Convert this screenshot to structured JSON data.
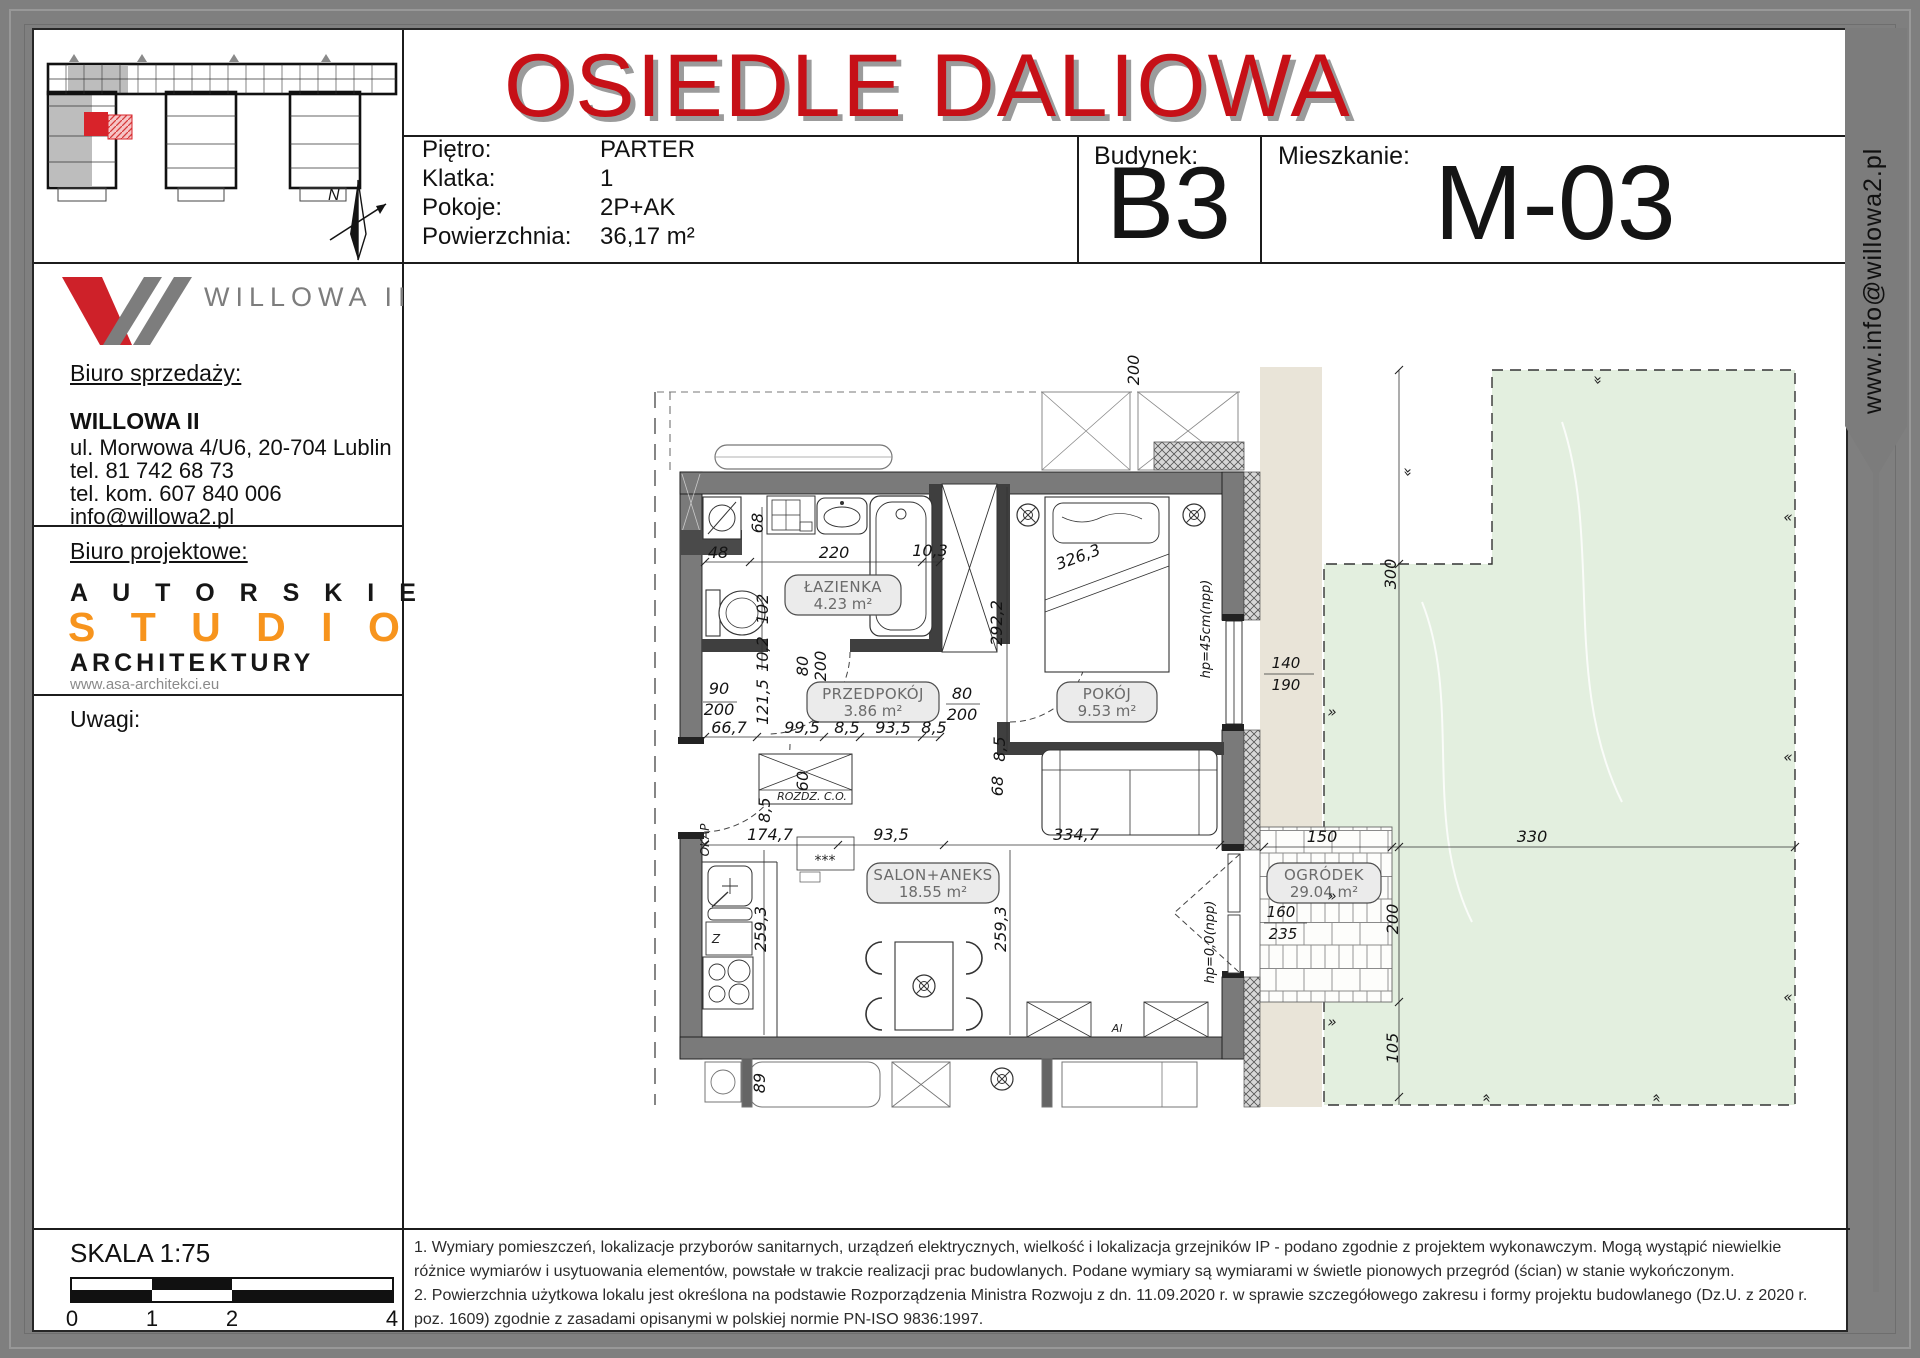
{
  "header": {
    "title": "OSIEDLE DALIOWA",
    "rows": [
      {
        "label": "Piętro:",
        "value": "PARTER"
      },
      {
        "label": "Klatka:",
        "value": "1"
      },
      {
        "label": "Pokoje:",
        "value": "2P+AK"
      },
      {
        "label": "Powierzchnia:",
        "value": "36,17 m²"
      }
    ],
    "budynek_label": "Budynek:",
    "budynek_value": "B3",
    "mieszkanie_label": "Mieszkanie:",
    "mieszkanie_value": "M-03"
  },
  "ribbon": {
    "text": "www.info@willowa2.pl"
  },
  "sidebar": {
    "logo_text": "WILLOWA II",
    "sales_heading": "Biuro sprzedaży:",
    "company": "WILLOWA II",
    "address": "ul. Morwowa 4/U6, 20-704 Lublin",
    "tel1": "tel. 81 742 68 73",
    "tel2": "tel. kom. 607 840 006",
    "email": "info@willowa2.pl",
    "design_heading": "Biuro projektowe:",
    "studio_line1": "A U T O R S K I E",
    "studio_line2": "S T U D I O",
    "studio_line3": "ARCHITEKTURY",
    "studio_site": "www.asa-architekci.eu",
    "uwagi_label": "Uwagi:"
  },
  "footer": {
    "skala_label": "SKALA 1:75",
    "scale_ticks": [
      "0",
      "1",
      "2",
      "4"
    ],
    "note1": "1. Wymiary pomieszczeń, lokalizacje przyborów sanitarnych, urządzeń elektrycznych, wielkość i lokalizacja grzejników IP - podano zgodnie z projektem wykonawczym. Mogą wystąpić niewielkie różnice wymiarów i usytuowania elementów, powstałe w trakcie realizacji prac budowlanych. Podane wymiary są wymiarami w świetle pionowych przegród (ścian) w stanie wykończonym.",
    "note2": "2. Powierzchnia użytkowa lokalu jest określona na podstawie Rozporządzenia Ministra Rozwoju z dn. 11.09.2020 r. w sprawie szczegółowego zakresu i formy projektu budowlanego (Dz.U. z 2020 r. poz. 1609) zgodnie z zasadami opisanymi w polskiej normie PN-ISO 9836:1997."
  },
  "plan": {
    "rooms": [
      {
        "name": "ŁAZIENKA",
        "area": "4.23 m²",
        "x": 841,
        "y": 573,
        "w": 116
      },
      {
        "name": "PRZEDPOKÓJ",
        "area": "3.86 m²",
        "x": 871,
        "y": 680,
        "w": 132
      },
      {
        "name": "POKÓJ",
        "area": "9.53 m²",
        "x": 1105,
        "y": 680,
        "w": 100
      },
      {
        "name": "SALON+ANEKS",
        "area": "18.55 m²",
        "x": 931,
        "y": 861,
        "w": 132
      },
      {
        "name": "OGRÓDEK",
        "area": "29.04 m²",
        "x": 1322,
        "y": 861,
        "w": 114
      }
    ],
    "dims": [
      {
        "t": "48",
        "x": 716,
        "y": 556
      },
      {
        "t": "220",
        "x": 832,
        "y": 556
      },
      {
        "t": "10,3",
        "x": 928,
        "y": 554
      },
      {
        "t": "68",
        "x": 761,
        "y": 521,
        "r": -90
      },
      {
        "t": "102",
        "x": 766,
        "y": 607,
        "r": -90
      },
      {
        "t": "10,2",
        "x": 766,
        "y": 652,
        "r": -90
      },
      {
        "t": "292,2",
        "x": 1000,
        "y": 621,
        "r": -90
      },
      {
        "t": "326,3",
        "x": 1078,
        "y": 560,
        "r": -20
      },
      {
        "t": "90",
        "x": 717,
        "y": 692
      },
      {
        "t": "200",
        "x": 717,
        "y": 713
      },
      {
        "t": "66,7",
        "x": 727,
        "y": 731
      },
      {
        "t": "121,5",
        "x": 766,
        "y": 700,
        "r": -90
      },
      {
        "t": "99,5",
        "x": 800,
        "y": 731
      },
      {
        "t": "8,5",
        "x": 845,
        "y": 731
      },
      {
        "t": "93,5",
        "x": 891,
        "y": 731
      },
      {
        "t": "8,5",
        "x": 932,
        "y": 731
      },
      {
        "t": "80",
        "x": 806,
        "y": 664,
        "r": -90
      },
      {
        "t": "200",
        "x": 824,
        "y": 664,
        "r": -90
      },
      {
        "t": "80",
        "x": 960,
        "y": 697
      },
      {
        "t": "200",
        "x": 960,
        "y": 718
      },
      {
        "t": "60",
        "x": 806,
        "y": 779,
        "r": -90
      },
      {
        "t": "8,5",
        "x": 768,
        "y": 808,
        "r": -90
      },
      {
        "t": "174,7",
        "x": 768,
        "y": 838
      },
      {
        "t": "93,5",
        "x": 889,
        "y": 838
      },
      {
        "t": "334,7",
        "x": 1074,
        "y": 838
      },
      {
        "t": "68",
        "x": 1001,
        "y": 784,
        "r": -90
      },
      {
        "t": "8,5",
        "x": 1003,
        "y": 747,
        "r": -90
      },
      {
        "t": "259,3",
        "x": 764,
        "y": 927,
        "r": -90
      },
      {
        "t": "259,3",
        "x": 1004,
        "y": 927,
        "r": -90
      },
      {
        "t": "89",
        "x": 763,
        "y": 1081,
        "r": -90
      },
      {
        "t": "hp=45cm(npp)",
        "x": 1208,
        "y": 627,
        "r": -90,
        "s": 13
      },
      {
        "t": "140",
        "x": 1284,
        "y": 666,
        "s": 15
      },
      {
        "t": "190",
        "x": 1284,
        "y": 688,
        "s": 15
      },
      {
        "t": "hp=0,0(npp)",
        "x": 1212,
        "y": 940,
        "r": -90,
        "s": 13
      },
      {
        "t": "160",
        "x": 1279,
        "y": 915,
        "s": 15
      },
      {
        "t": "235",
        "x": 1281,
        "y": 937,
        "s": 15
      },
      {
        "t": "150",
        "x": 1320,
        "y": 840
      },
      {
        "t": "330",
        "x": 1530,
        "y": 840
      },
      {
        "t": "300",
        "x": 1394,
        "y": 572,
        "r": -90
      },
      {
        "t": "200",
        "x": 1396,
        "y": 917,
        "r": -90
      },
      {
        "t": "105",
        "x": 1396,
        "y": 1046,
        "r": -90
      },
      {
        "t": "200",
        "x": 1137,
        "y": 368,
        "r": -90
      }
    ],
    "labels": [
      {
        "t": "OKAP",
        "x": 707,
        "y": 838,
        "r": -90,
        "s": 12
      },
      {
        "t": "ROZDZ. C.O.",
        "x": 810,
        "y": 798,
        "s": 11
      },
      {
        "t": "Z",
        "x": 714,
        "y": 941,
        "s": 12
      },
      {
        "t": "***",
        "x": 823,
        "y": 863,
        "s": 14
      },
      {
        "t": "Al",
        "x": 1115,
        "y": 1030,
        "s": 11
      },
      {
        "t": "«",
        "x": 1330,
        "y": 706,
        "r": 180,
        "s": 15
      },
      {
        "t": "«",
        "x": 1330,
        "y": 890,
        "r": 180,
        "s": 15
      },
      {
        "t": "«",
        "x": 1330,
        "y": 1016,
        "r": 180,
        "s": 15
      },
      {
        "t": "«",
        "x": 1786,
        "y": 520,
        "s": 15
      },
      {
        "t": "«",
        "x": 1786,
        "y": 760,
        "s": 15
      },
      {
        "t": "«",
        "x": 1786,
        "y": 1000,
        "s": 15
      },
      {
        "t": "«",
        "x": 1480,
        "y": 1096,
        "r": 90,
        "s": 15
      },
      {
        "t": "«",
        "x": 1650,
        "y": 1096,
        "r": 90,
        "s": 15
      },
      {
        "t": "«",
        "x": 1600,
        "y": 378,
        "r": -90,
        "s": 15
      },
      {
        "t": "«",
        "x": 1410,
        "y": 470,
        "r": -90,
        "s": 15
      }
    ]
  },
  "colors": {
    "accent_red": "#c61017",
    "logo_red": "#ce2129",
    "logo_gray": "#7d7d7d",
    "studio_orange": "#f7941d",
    "garden_green": "#e3efdf",
    "terrace_beige": "#e9e4d8",
    "frame_gray": "#7f7f7f"
  }
}
